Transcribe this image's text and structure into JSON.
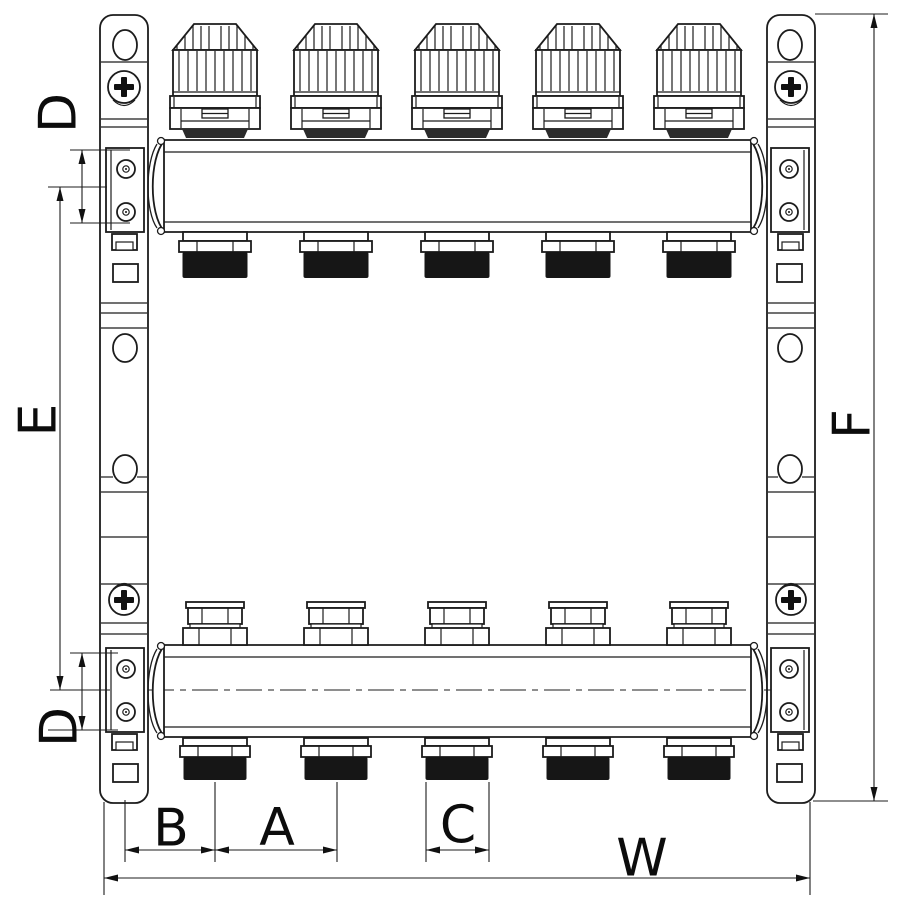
{
  "figure": {
    "kind": "technical dimension drawing",
    "subject": "heating manifold with 5 thermostatic valve circuits, front view",
    "circuit_count": 5
  },
  "labels": {
    "d_top": "D",
    "e_left": "E",
    "d_bottom": "D",
    "f_right": "F",
    "b": "B",
    "a": "A",
    "c": "C",
    "w": "W"
  },
  "colors": {
    "line": "#1c1c1c",
    "thread_fill": "#161616",
    "base_fill": "#2b2b2b",
    "label": "#0c0c0c",
    "background": "#ffffff"
  }
}
